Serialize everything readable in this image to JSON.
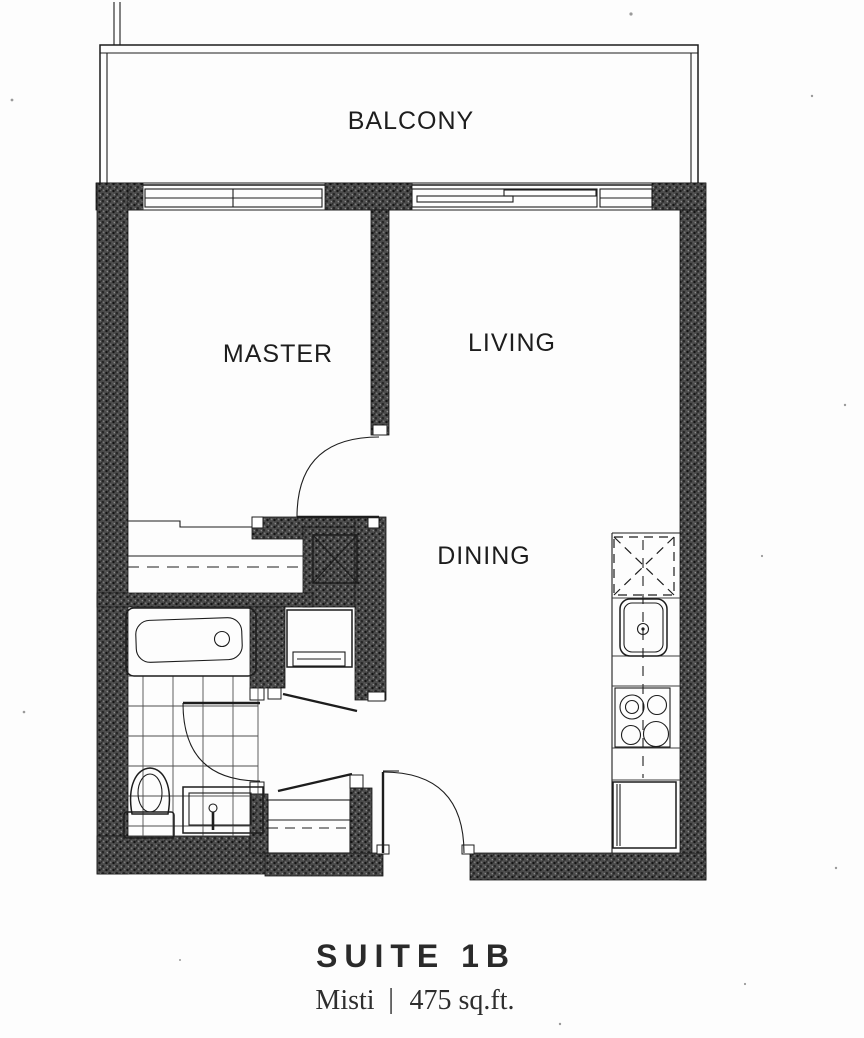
{
  "plan": {
    "rooms": {
      "balcony": {
        "label": "BALCONY"
      },
      "master": {
        "label": "MASTER"
      },
      "living": {
        "label": "LIVING"
      },
      "dining": {
        "label": "DINING"
      }
    },
    "title": {
      "suite": "SUITE 1B",
      "model": "Misti",
      "separator": "|",
      "area": "475 sq.ft."
    },
    "fixtures": [
      "bathtub",
      "toilet",
      "vanity-sink",
      "tile-floor",
      "washer",
      "coat-closet",
      "master-closet",
      "structural-column",
      "kitchen-sink",
      "cooktop",
      "refrigerator",
      "dashed-appliance-box",
      "entry-door",
      "master-door",
      "bathroom-door",
      "balcony-sliding-door",
      "master-window",
      "living-window"
    ],
    "colors": {
      "line": "#1d1d1d",
      "wall": "#474747",
      "paper": "#fcfcfc"
    }
  }
}
